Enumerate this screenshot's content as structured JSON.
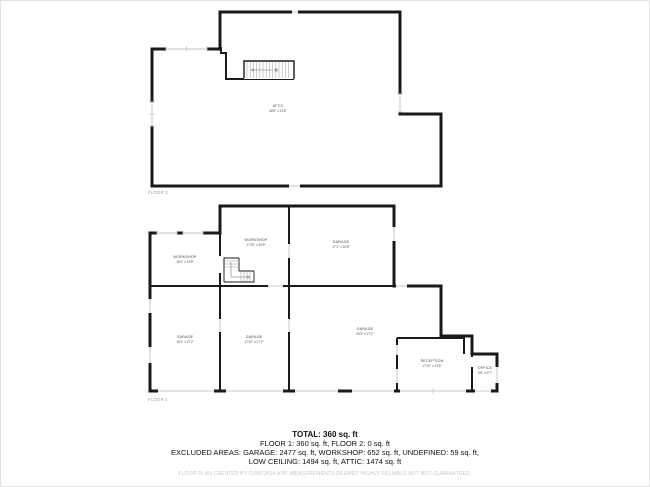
{
  "colors": {
    "wall": "#1a1a1a",
    "window": "#c2c2c2",
    "stair_tread": "#b9b9b9",
    "room_label": "#444444",
    "caption": "#9a9a9a",
    "disclaimer": "#c6c6c6",
    "background": "#ffffff"
  },
  "floor2": {
    "caption": "FLOOR 2",
    "rooms": [
      {
        "name": "ATTIC",
        "dims": "46'6\" x 31'8\""
      }
    ]
  },
  "floor1": {
    "caption": "FLOOR 1",
    "rooms": [
      {
        "name": "WORKSHOP",
        "dims": "18'1\" x 13'8\""
      },
      {
        "name": "WORKSHOP",
        "dims": "17'10\" x 20'8\""
      },
      {
        "name": "GARAGE",
        "dims": "27'1\" x 20'8\""
      },
      {
        "name": "GARAGE",
        "dims": "18'1\" x 27'2\""
      },
      {
        "name": "GARAGE",
        "dims": "17'10\" x 27'2\""
      },
      {
        "name": "GARAGE",
        "dims": "39'3\" x 27'2\""
      },
      {
        "name": "RECEPTION",
        "dims": "17'10\" x 13'5\""
      },
      {
        "name": "OFFICE",
        "dims": "6'6\" x 9'7\""
      }
    ]
  },
  "summary": {
    "total": "TOTAL: 360 sq. ft",
    "floors_line": "FLOOR 1: 360 sq. ft, FLOOR 2: 0 sq. ft",
    "excluded_line1": "EXCLUDED AREAS: GARAGE: 2477 sq. ft, WORKSHOP: 652 sq. ft, UNDEFINED: 59 sq. ft,",
    "excluded_line2": "LOW CEILING: 1494 sq. ft, ATTIC: 1474 sq. ft",
    "disclaimer": "FLOOR PLAN CREATED BY CUBICASA APP. MEASUREMENTS DEEMED HIGHLY RELIABLE BUT NOT GUARANTEED."
  }
}
